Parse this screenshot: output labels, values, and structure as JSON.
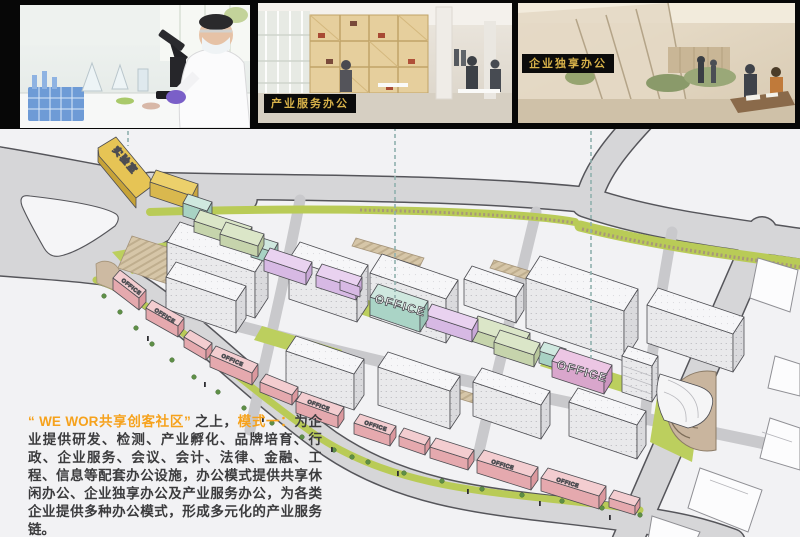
{
  "photos": {
    "lab": {
      "name": "laboratory-rendering"
    },
    "service_office": {
      "label": "产业服务办公"
    },
    "exclusive_office": {
      "label": "企业独享办公"
    }
  },
  "plan": {
    "lab_label": "实验室",
    "office_label": "OFFICE"
  },
  "description": {
    "seg1": "“ WE WOR共享创客社区”",
    "seg2": " 之上，",
    "seg3": "模式一：",
    "seg4": "为企业提供研发、检测、产业孵化、品牌培育、行政、企业服务、会议、会计、法律、金融、工程、信息等配套办公设施，办公模式提供共享休闲办公、企业独享办公及产业服务办公，为各类企业提供多种办公模式，形成多元化的产业服务链。"
  },
  "colors": {
    "accent_orange": "#F6A21C",
    "label_gold": "#D8B24A",
    "building_yellow": "#ECD06B",
    "building_mint": "#CFE8DF",
    "building_sage": "#DBE6C8",
    "building_lavender": "#E9D2F0",
    "building_pink": "#F3CDD0",
    "office_pink_violet": "#ECC6E4",
    "landscape_green": "#B9CB57",
    "road_gray": "#D6D6D8",
    "plaza_tan": "#C9B59E"
  }
}
